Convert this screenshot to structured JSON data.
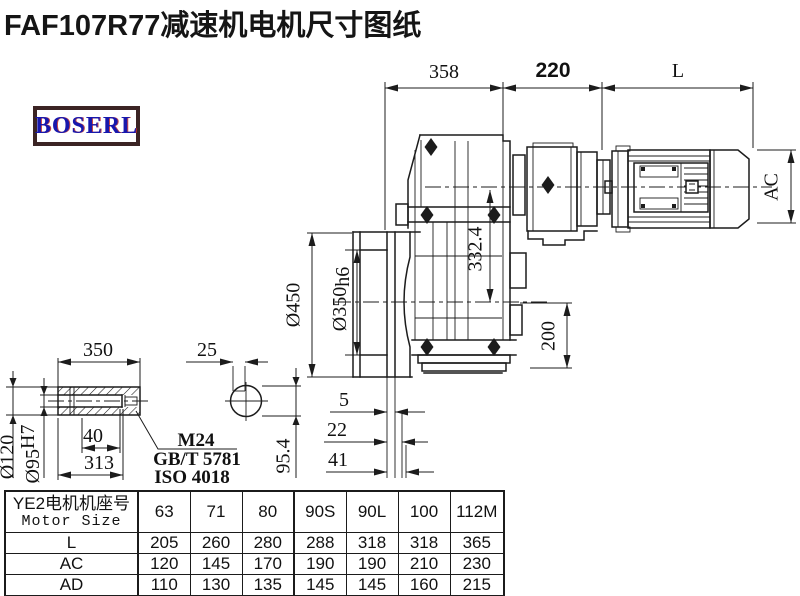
{
  "page": {
    "title": "FAF107R77减速机电机尺寸图纸"
  },
  "logo": {
    "text": "BOSERL"
  },
  "drawing": {
    "dims": {
      "t358": "358",
      "t220": "220",
      "tL": "L",
      "ac": "AC",
      "v332": "332.4",
      "v200": "200",
      "d450": "Ø450",
      "d350": "Ø350",
      "d350t": "h6",
      "g5": "5",
      "g22": "22",
      "g41": "41",
      "v954": "95.4"
    },
    "shaft": {
      "len": "350",
      "key": "25",
      "d120": "Ø120",
      "d95": "Ø95",
      "d95t": "H7",
      "w40": "40",
      "l313": "313",
      "thread": "M24",
      "std1": "GB/T 5781",
      "std2": "ISO 4018"
    }
  },
  "table": {
    "header_cn": "YE2电机机座号",
    "header_en": "Motor Size",
    "sizes": [
      "63",
      "71",
      "80",
      "90S",
      "90L",
      "100",
      "112M"
    ],
    "rows": [
      {
        "label": "L",
        "values": [
          "205",
          "260",
          "280",
          "288",
          "318",
          "318",
          "365"
        ]
      },
      {
        "label": "AC",
        "values": [
          "120",
          "145",
          "170",
          "190",
          "190",
          "210",
          "230"
        ]
      },
      {
        "label": "AD",
        "values": [
          "110",
          "130",
          "135",
          "145",
          "145",
          "160",
          "215"
        ]
      }
    ]
  }
}
